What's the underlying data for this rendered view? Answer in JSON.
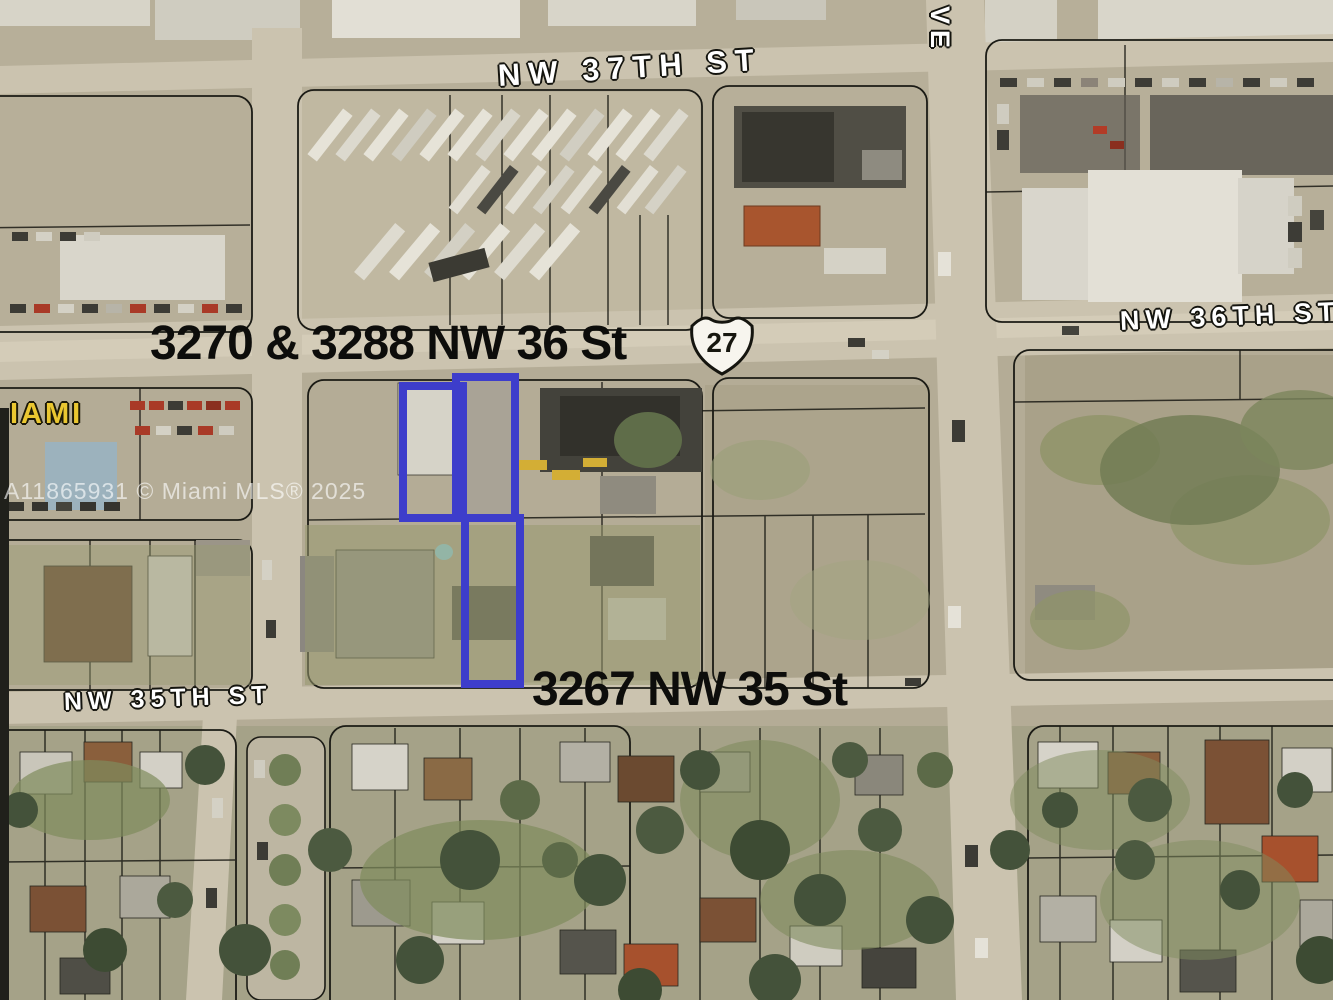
{
  "map": {
    "type": "aerial-satellite-parcel-map",
    "watermark": "A11865931 © Miami MLS® 2025",
    "streets": {
      "nw_37th_st": "NW 37TH ST",
      "nw_36th_st": "NW 36TH ST",
      "nw_35th_st": "NW 35TH ST",
      "avenue_partial": "VE"
    },
    "labels": {
      "parcels_north": "3270 & 3288 NW 36 St",
      "parcel_south": "3267 NW 35 St",
      "route_number": "27",
      "city_partial": "IAMI"
    },
    "colors": {
      "parcel_outline_blue": "#3d3dcb",
      "ground_tan": "#b4ac96",
      "road": "#cbc3af",
      "city_label_yellow": "#eac731",
      "street_label_white": "#ffffff",
      "address_label_black": "#0d0d0b"
    }
  }
}
